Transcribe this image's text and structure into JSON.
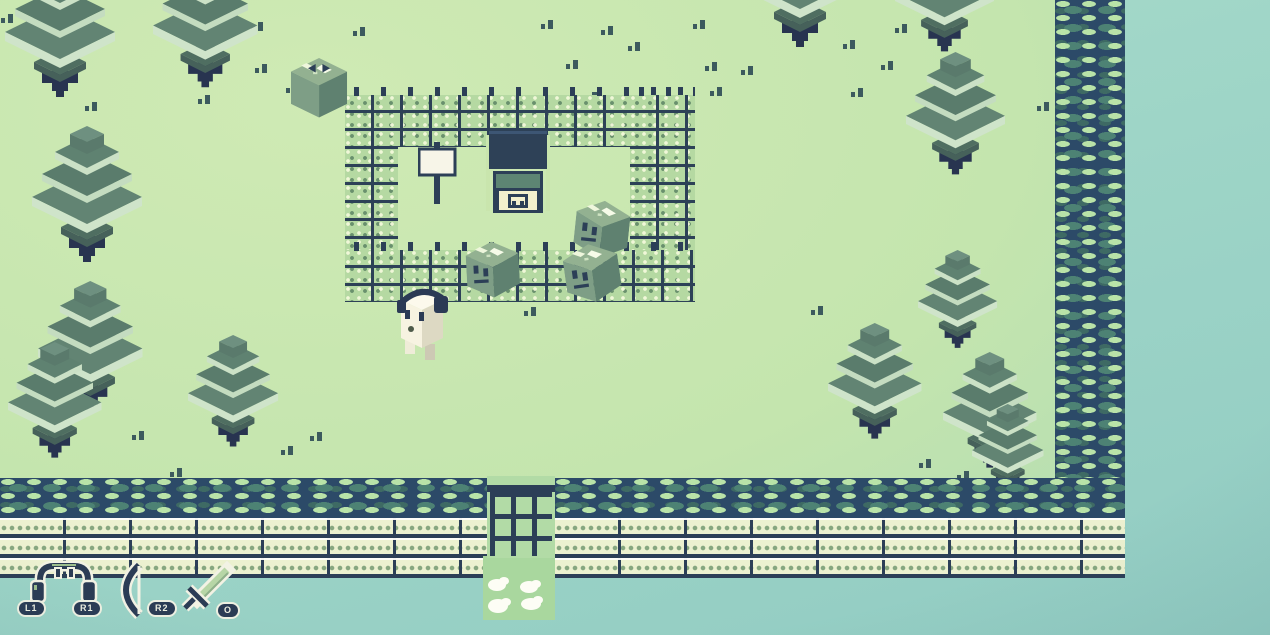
{
  "meta": {
    "scene_width": 1270,
    "scene_height": 635,
    "style": "isometric pixel-art overworld, GameBoy-like green palette"
  },
  "hud": {
    "buttons": [
      {
        "label": "L1",
        "icon": "headphones-icon"
      },
      {
        "label": "R1",
        "icon": "headphones-icon"
      },
      {
        "label": "R2",
        "icon": "bow-icon"
      },
      {
        "label": "O",
        "icon": "sword-icon"
      }
    ]
  },
  "palette": {
    "ground_light": "#cfeab4",
    "ground_teal": "#a5d5bd",
    "void_top": "#aadcca",
    "void_bottom": "#92ccc3",
    "outline_navy": "#2c3f57",
    "trunk_navy": "#283450",
    "moss_base": "#2c4a68",
    "moss_mid": "#4d8274",
    "moss_light": "#b9e3a8",
    "compound_brick": "#b5d9a2",
    "outer_brick": "#ecf1d0",
    "tree_dark": "#5d7f6e",
    "tree_band_light": "#cbe1c6",
    "cube_top": "#93b191",
    "cube_front": "#7e9e86",
    "cube_side": "#5f8170",
    "player_body": "#f7f3e1",
    "door_cream": "#f3f0cd",
    "panel_green": "#5d8573",
    "hud_pill": "#2b3c55",
    "hud_text": "#eef0e2",
    "sword_blade": "#b7d6a6",
    "path_green": "#a9d79e",
    "flower_white": "#fdfdf5"
  },
  "world": {
    "trees": [
      {
        "x": 5,
        "y": -39,
        "s": 1.0,
        "z": 90
      },
      {
        "x": 153,
        "y": -42,
        "s": 0.95,
        "z": 90
      },
      {
        "x": 32,
        "y": 126,
        "s": 1.0,
        "z": 95
      },
      {
        "x": 38,
        "y": 281,
        "s": 0.95,
        "z": 96
      },
      {
        "x": 8,
        "y": 342,
        "s": 0.85,
        "z": 97
      },
      {
        "x": 188,
        "y": 335,
        "s": 0.82,
        "z": 96
      },
      {
        "x": 745,
        "y": -89,
        "s": 1.0,
        "z": 90
      },
      {
        "x": 895,
        "y": -71,
        "s": 0.9,
        "z": 90
      },
      {
        "x": 906,
        "y": 52,
        "s": 0.9,
        "z": 95
      },
      {
        "x": 918,
        "y": 250,
        "s": 0.72,
        "z": 95
      },
      {
        "x": 828,
        "y": 323,
        "s": 0.85,
        "z": 96
      },
      {
        "x": 943,
        "y": 352,
        "s": 0.85,
        "z": 97
      },
      {
        "x": 972,
        "y": 404,
        "s": 0.65,
        "z": 98
      }
    ],
    "cubes": [
      {
        "x": 291,
        "y": 58,
        "s": 0.85,
        "z": 200,
        "v": "eyes-top"
      },
      {
        "x": 578,
        "y": 198,
        "s": 0.82,
        "r": 6,
        "z": 210
      },
      {
        "x": 465,
        "y": 243,
        "s": 0.8,
        "r": -3,
        "z": 215
      },
      {
        "x": 561,
        "y": 248,
        "s": 0.83,
        "r": -8,
        "z": 215
      }
    ],
    "player": {
      "x": 397,
      "y": 286,
      "s": 1.0,
      "z": 220
    },
    "sign": {
      "x": 418,
      "y": 142,
      "s": 1.0,
      "z": 160
    },
    "house": {
      "x": 486,
      "y": 131,
      "s": 1.0,
      "z": 160
    },
    "grass_specks": [
      {
        "x": 8,
        "y": 14
      },
      {
        "x": 258,
        "y": 22
      },
      {
        "x": 262,
        "y": 64
      },
      {
        "x": 293,
        "y": 84
      },
      {
        "x": 92,
        "y": 102
      },
      {
        "x": 205,
        "y": 95
      },
      {
        "x": 360,
        "y": 27
      },
      {
        "x": 548,
        "y": 20
      },
      {
        "x": 608,
        "y": 26
      },
      {
        "x": 700,
        "y": 20
      },
      {
        "x": 635,
        "y": 42
      },
      {
        "x": 573,
        "y": 60
      },
      {
        "x": 712,
        "y": 62
      },
      {
        "x": 748,
        "y": 66
      },
      {
        "x": 850,
        "y": 40
      },
      {
        "x": 888,
        "y": 61
      },
      {
        "x": 858,
        "y": 88
      },
      {
        "x": 902,
        "y": 24
      },
      {
        "x": 1044,
        "y": 102
      },
      {
        "x": 566,
        "y": 120
      },
      {
        "x": 592,
        "y": 92
      },
      {
        "x": 662,
        "y": 103
      },
      {
        "x": 139,
        "y": 431
      },
      {
        "x": 177,
        "y": 468
      },
      {
        "x": 288,
        "y": 446
      },
      {
        "x": 317,
        "y": 432
      },
      {
        "x": 531,
        "y": 307
      },
      {
        "x": 818,
        "y": 306
      },
      {
        "x": 926,
        "y": 459
      },
      {
        "x": 964,
        "y": 471
      },
      {
        "x": 418,
        "y": 100
      },
      {
        "x": 717,
        "y": 87
      }
    ]
  }
}
